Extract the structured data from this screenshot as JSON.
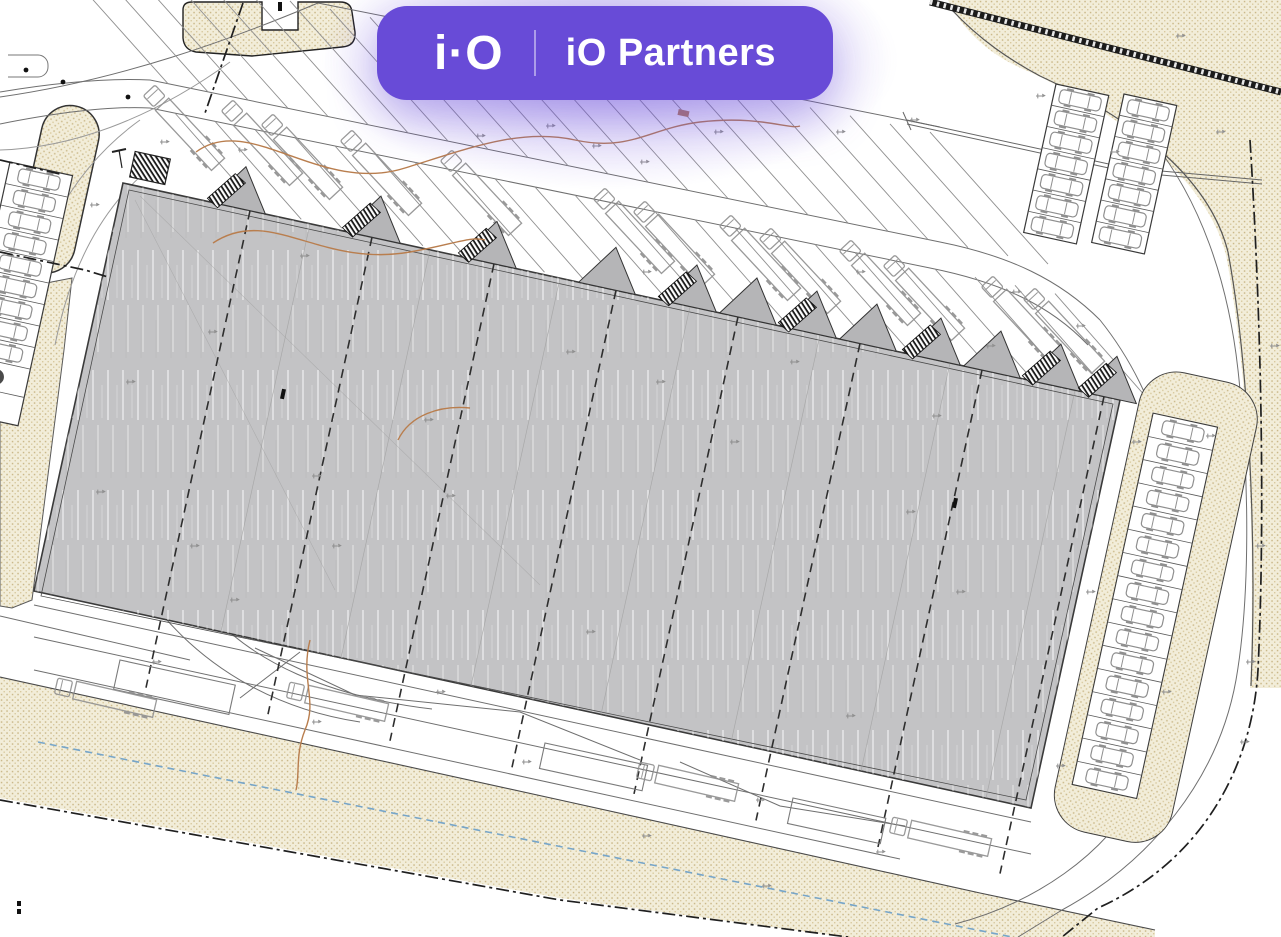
{
  "brand": {
    "logo": "i·O",
    "name": "iO Partners"
  },
  "colors": {
    "badge_purple": "#684bd7",
    "building_fill": "#c3c3c5",
    "gable_fill": "#b5b5b7",
    "landscaping_beige": "#f2edd9",
    "landscaping_dot": "#cbb98a",
    "line_dark": "#1f1f1f",
    "line_mid": "#6f6f6f",
    "line_light": "#8f8f8f",
    "contour_orange": "#b97e4e",
    "utility_blue": "#76a5c9"
  },
  "site": {
    "dock_gables": 12,
    "left_car_stalls": 9,
    "left_accessible_stalls": 2,
    "right_car_stalls": 16,
    "upper_right_stalls_per_row": 7,
    "trucks_top": 13,
    "trucks_bottom": 4
  }
}
